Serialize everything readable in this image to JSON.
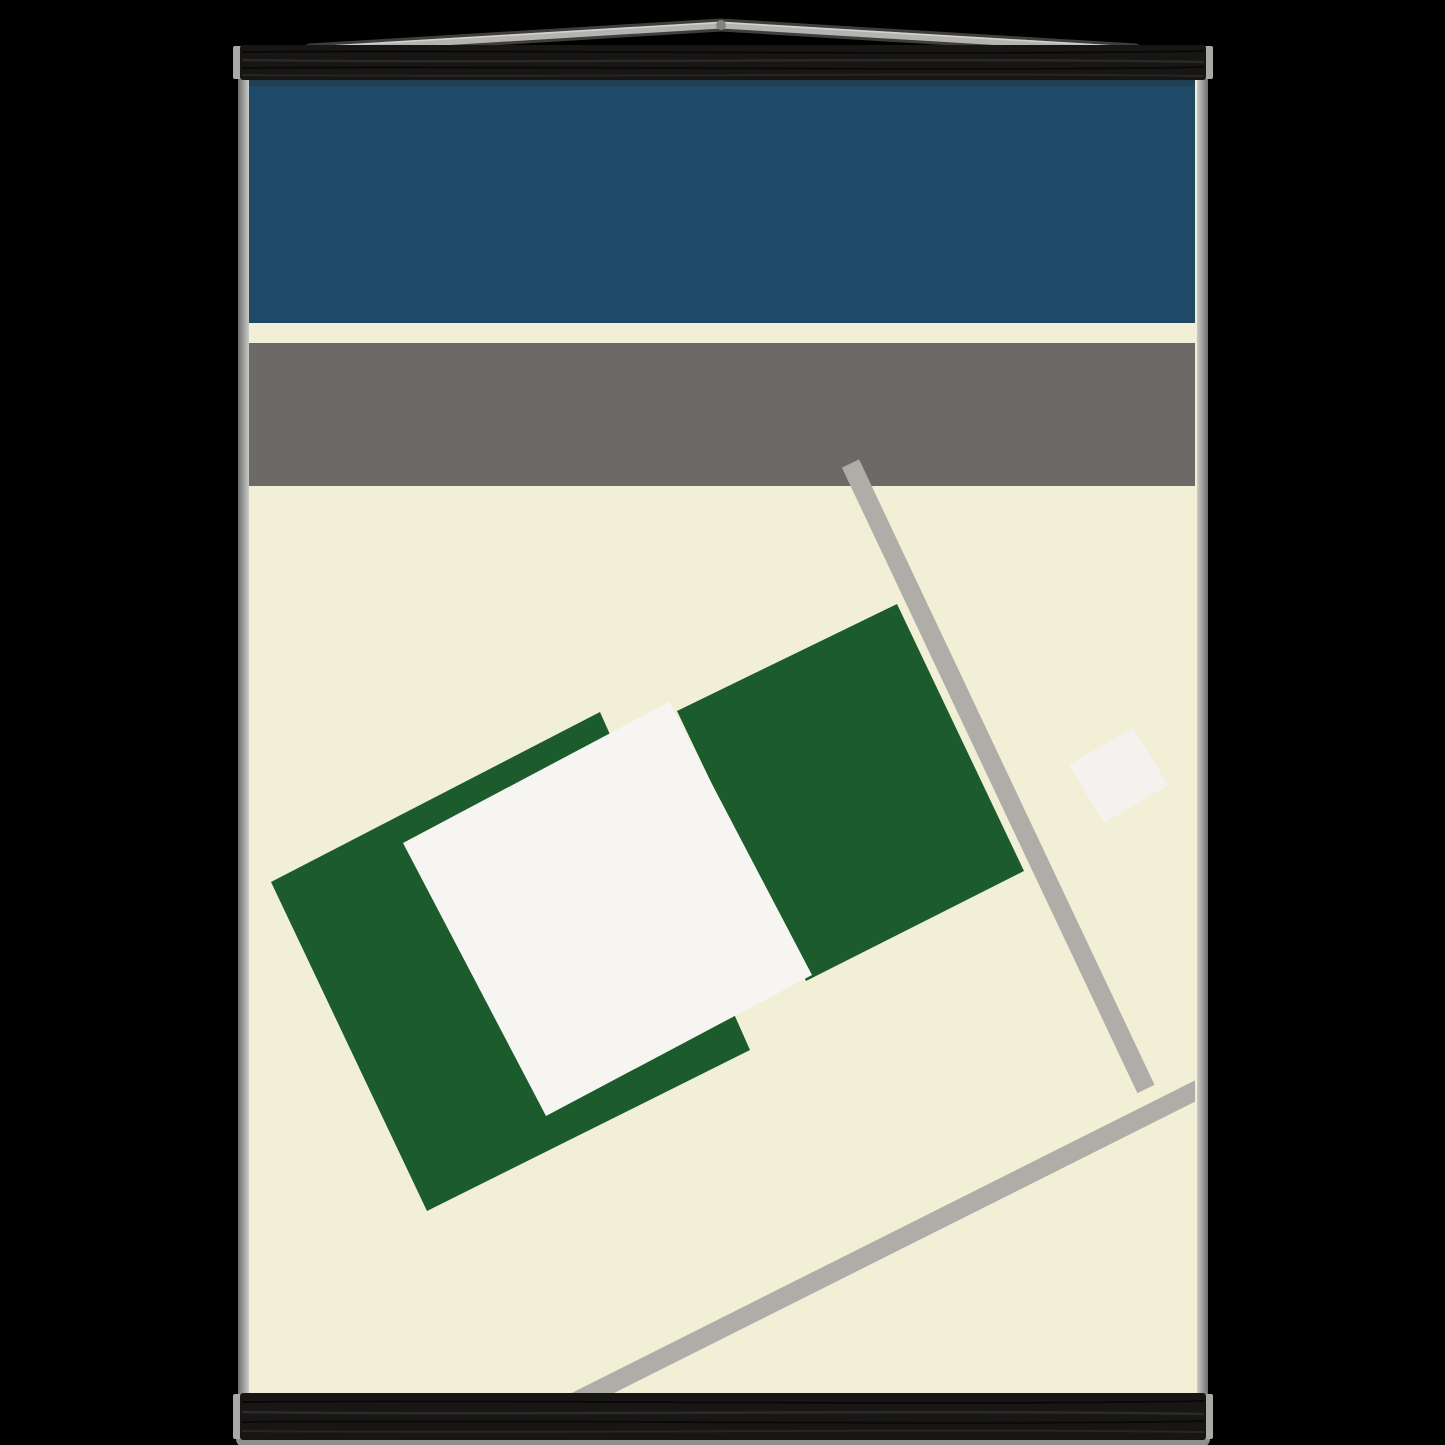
{
  "scene": {
    "background": "#000000"
  },
  "poster": {
    "paper": "#f1f0d7",
    "edge_light": "#cbcbc8",
    "edge_dark": "#6e6e6c"
  },
  "artwork": {
    "blue_band": "#1e4a68",
    "divider_cream": "#f1f0d7",
    "gray_band": "#6b6a66",
    "road_gray": "#aeada7",
    "green_block": "#1b5b2c",
    "white_block": "#f6f5f2",
    "small_white_square": "#f4f2ef"
  },
  "hanger": {
    "wood_black": "#171615",
    "end_cap_gray": "#a9a9a6",
    "cord_gray": "#b4b3af",
    "cord_knot_gray": "#82827f",
    "shadow_gray": "#8f8f8c"
  }
}
